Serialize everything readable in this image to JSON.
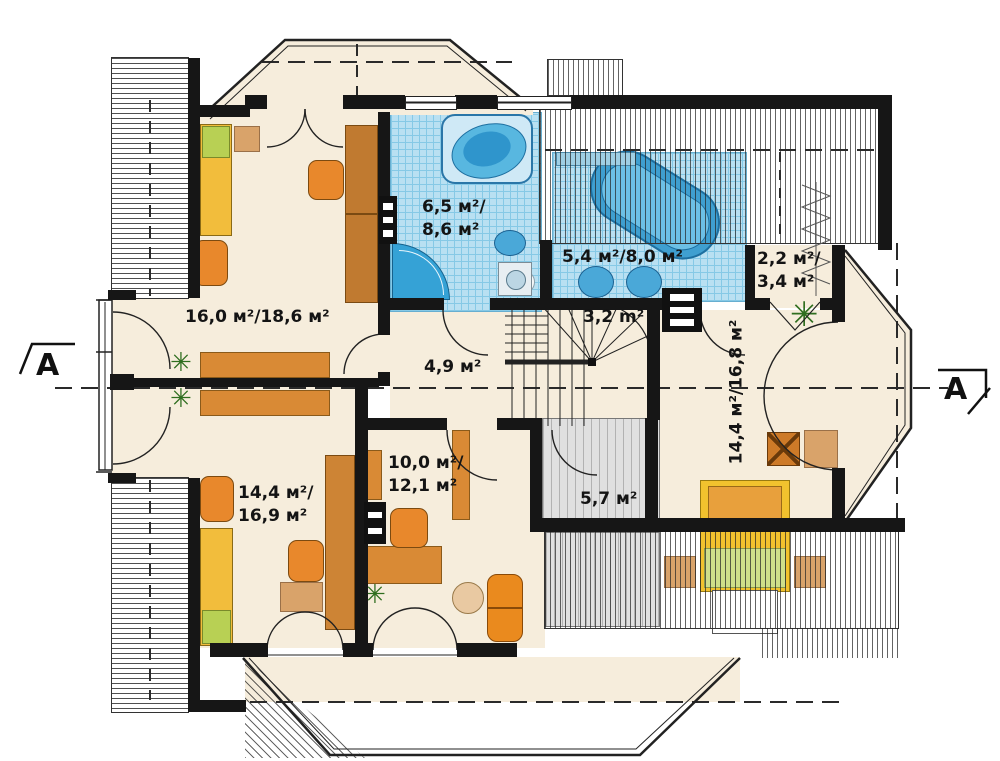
{
  "plan": {
    "section_marks": {
      "left": "A",
      "right": "A"
    },
    "icons": {
      "plant": "✳"
    },
    "rooms": {
      "bedroom_top_left": {
        "area": "16,0 м²/18,6 м²"
      },
      "bathroom_small": {
        "line1": "6,5 м²/",
        "line2": "8,6 м²"
      },
      "bathroom_large": {
        "area": "5,4 м²/8,0 м²"
      },
      "wardrobe_closet": {
        "line1": "2,2 м²/",
        "line2": "3,4 м²"
      },
      "staircase": {
        "area": "3,2 m²"
      },
      "hall": {
        "area": "4,9 м²"
      },
      "bedroom_bottom_left": {
        "line1": "14,4 м²/",
        "line2": "16,9 м²"
      },
      "study": {
        "line1": "10,0 м²/",
        "line2": "12,1 м²"
      },
      "void_space": {
        "area": "5,7 м²"
      },
      "bedroom_right": {
        "area": "14,4 м²/16,8 м²"
      }
    }
  }
}
